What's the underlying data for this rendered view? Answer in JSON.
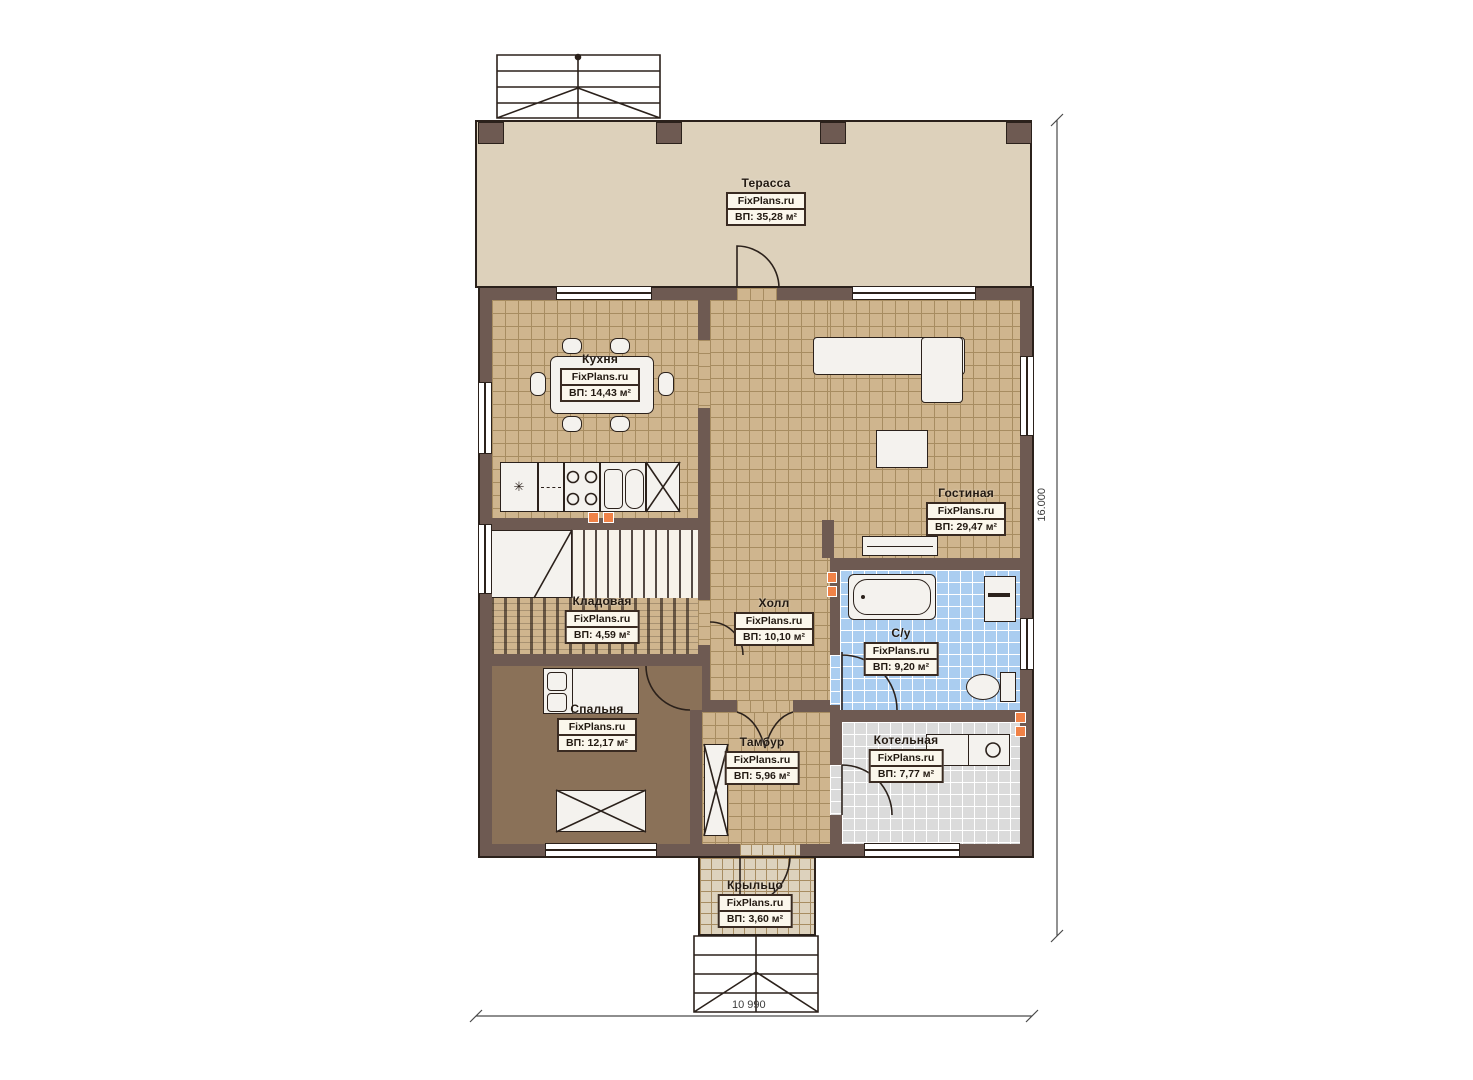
{
  "brand": "FixPlans.ru",
  "rooms": [
    {
      "id": "terrace",
      "name": "Терасса",
      "area": "ВП: 35,28 м²"
    },
    {
      "id": "kitchen",
      "name": "Кухня",
      "area": "ВП: 14,43 м²"
    },
    {
      "id": "living",
      "name": "Гостиная",
      "area": "ВП: 29,47 м²"
    },
    {
      "id": "hall",
      "name": "Холл",
      "area": "ВП: 10,10 м²"
    },
    {
      "id": "pantry",
      "name": "Кладовая",
      "area": "ВП: 4,59 м²"
    },
    {
      "id": "bedroom",
      "name": "Спальня",
      "area": "ВП: 12,17 м²"
    },
    {
      "id": "bathroom",
      "name": "С/у",
      "area": "ВП: 9,20 м²"
    },
    {
      "id": "vestibule",
      "name": "Тамбур",
      "area": "ВП: 5,96 м²"
    },
    {
      "id": "boiler",
      "name": "Котельная",
      "area": "ВП: 7,77 м²"
    },
    {
      "id": "porch",
      "name": "Крыльцо",
      "area": "ВП: 3,60 м²"
    }
  ],
  "dimensions": {
    "bottom": "10 990",
    "right": "16.000"
  },
  "icons": {
    "fridge_glyph": "✳"
  },
  "colors": {
    "wall": "#6e5a52",
    "line": "#2b211b",
    "terrace": "#ddd1bb",
    "tile": "#cfb58e",
    "tile_line": "#a78c61",
    "bedroom": "#8a7158",
    "bath": "#aacdf0",
    "boiler": "#dbdbdb",
    "porch": "#ddd2bd",
    "stairs": "#f7f3ea",
    "vent": "#f08247",
    "label_bg": "#fbf7ec"
  }
}
